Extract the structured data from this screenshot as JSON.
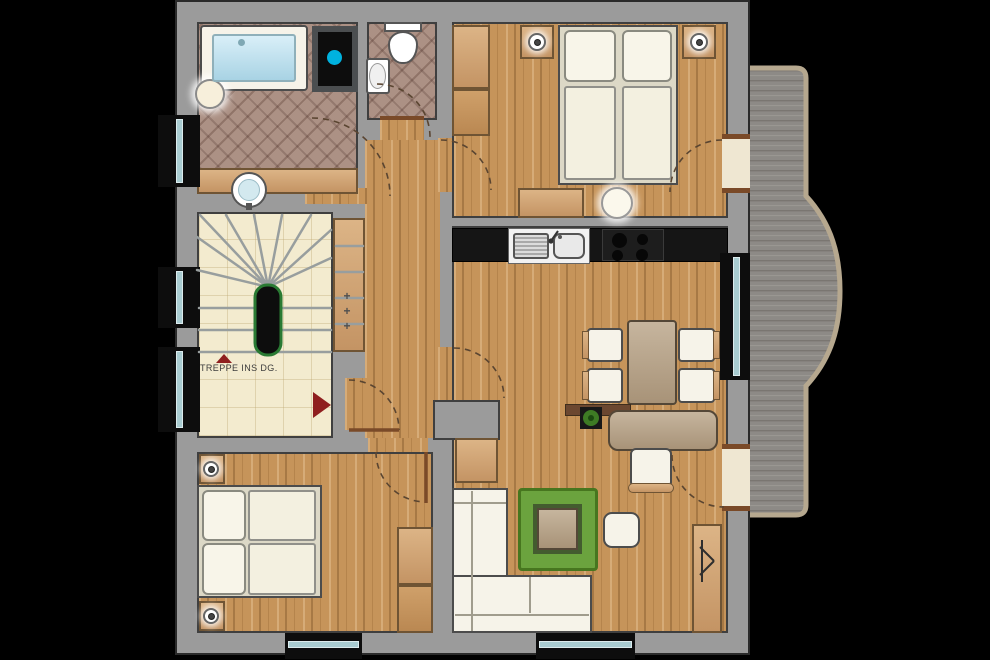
{
  "meta": {
    "type": "architectural-floor-plan",
    "view": "top-down apartment floor plan"
  },
  "stair": {
    "label": "TREPPE INS DG.",
    "direction_arrow": "up",
    "plus_marks": [
      "+",
      "+",
      "+"
    ],
    "handrail_color": "#2a7a33"
  },
  "rooms": [
    {
      "name": "bathroom",
      "floor": "tile",
      "furniture": [
        "bathtub",
        "stool",
        "vanity-washbasin",
        "installation-shaft"
      ]
    },
    {
      "name": "wc",
      "floor": "tile",
      "furniture": [
        "toilet",
        "hand-washbasin"
      ]
    },
    {
      "name": "hallway",
      "floor": "wood",
      "furniture": []
    },
    {
      "name": "stair-room",
      "floor": "cream-tile",
      "furniture": [
        "winder-staircase",
        "entry-steps"
      ]
    },
    {
      "name": "bedroom-top",
      "floor": "wood",
      "furniture": [
        "double-bed",
        "nightstand-left",
        "nightstand-right",
        "wardrobe",
        "dresser",
        "pouf"
      ]
    },
    {
      "name": "kitchen-dining",
      "floor": "wood",
      "furniture": [
        "counter",
        "sink-unit",
        "cooktop",
        "dining-table",
        "chair",
        "chair",
        "chair",
        "chair"
      ]
    },
    {
      "name": "living-room",
      "floor": "wood",
      "furniture": [
        "corner-sofa",
        "rug",
        "coffee-table",
        "side-table",
        "desk",
        "desk-chair",
        "plant",
        "cabinet",
        "tv-lowboard"
      ]
    },
    {
      "name": "bedroom-bottom",
      "floor": "wood",
      "furniture": [
        "double-bed",
        "nightstand-top",
        "nightstand-bottom",
        "wardrobe"
      ]
    },
    {
      "name": "balcony",
      "floor": "gray-deck",
      "furniture": []
    }
  ],
  "colors": {
    "wall": "#9b9b9b",
    "wood_floor": "#c6945a",
    "bath_tile": "#a78a7d",
    "stair_tile": "#f3ebcf",
    "window_glass": "#a9ccd1",
    "deck": "#8d8a86",
    "railing": "#b6a88f",
    "rug_green": "#6ba33e",
    "arrow_red": "#8f1f1f",
    "shaft_dot_cyan": "#00b2df",
    "counter_black": "#151515",
    "door_threshold": "#7a4a28"
  }
}
